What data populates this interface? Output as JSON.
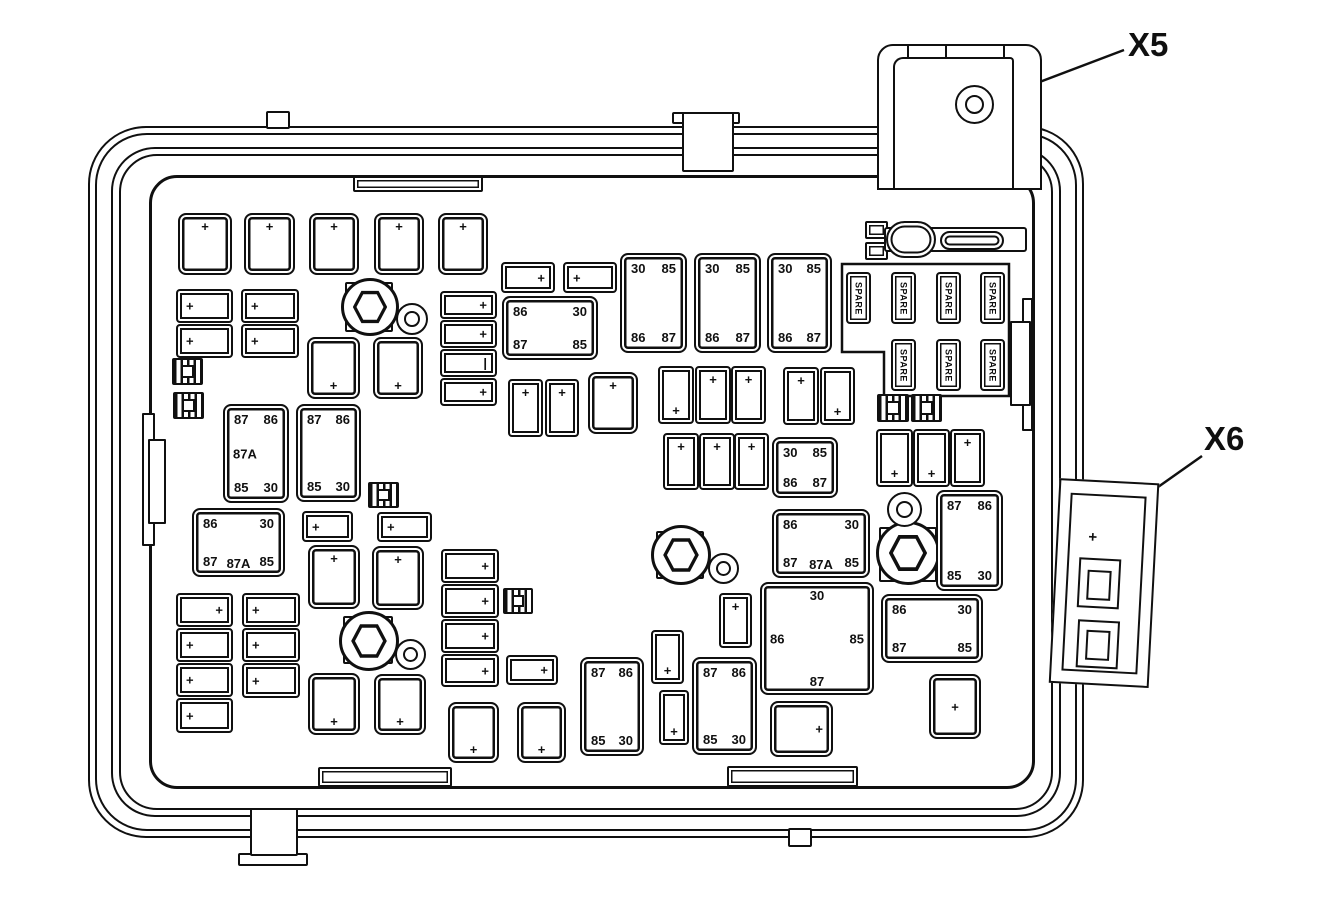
{
  "diagram": {
    "description": "Underhood fuse block line diagram with relay and fuse cavities",
    "connector_labels": {
      "x5": "X5",
      "x6": "X6"
    }
  },
  "labels": {
    "spare": "SPARE",
    "plus": "+",
    "pipe": "|"
  },
  "parts": [
    {
      "t": "rail",
      "x": 142,
      "y": 413,
      "w": 13,
      "h": 133
    },
    {
      "t": "rail",
      "x": 148,
      "y": 439,
      "w": 18,
      "h": 85
    },
    {
      "t": "rail",
      "x": 1022,
      "y": 298,
      "w": 11,
      "h": 133
    },
    {
      "t": "rail",
      "x": 1010,
      "y": 321,
      "w": 21,
      "h": 85
    },
    {
      "t": "ledge",
      "x": 353,
      "y": 176,
      "w": 130,
      "h": 16
    },
    {
      "t": "ledge",
      "x": 318,
      "y": 767,
      "w": 134,
      "h": 20
    },
    {
      "t": "ledge",
      "x": 727,
      "y": 766,
      "w": 131,
      "h": 21
    },
    {
      "t": "tab",
      "x": 266,
      "y": 111,
      "w": 24,
      "h": 18
    },
    {
      "t": "tab",
      "x": 672,
      "y": 112,
      "w": 68,
      "h": 12
    },
    {
      "t": "tab",
      "x": 682,
      "y": 112,
      "w": 52,
      "h": 60
    },
    {
      "t": "tab",
      "x": 238,
      "y": 853,
      "w": 70,
      "h": 13
    },
    {
      "t": "tab",
      "x": 250,
      "y": 808,
      "w": 48,
      "h": 48
    },
    {
      "t": "tab",
      "x": 788,
      "y": 828,
      "w": 24,
      "h": 19
    },
    {
      "t": "sq",
      "x": 865,
      "y": 221,
      "w": 23,
      "h": 18
    },
    {
      "t": "sq",
      "x": 865,
      "y": 242,
      "w": 23,
      "h": 18
    },
    {
      "t": "bar",
      "x": 884,
      "y": 227,
      "w": 143,
      "h": 25
    },
    {
      "t": "pill",
      "x": 886,
      "y": 221,
      "w": 50,
      "h": 37
    },
    {
      "t": "pill",
      "x": 940,
      "y": 231,
      "w": 64,
      "h": 19
    },
    {
      "t": "pad",
      "x": 345,
      "y": 282,
      "w": 48,
      "h": 50
    },
    {
      "t": "hex",
      "x": 341,
      "y": 278,
      "w": 58,
      "h": 58
    },
    {
      "t": "washer",
      "x": 396,
      "y": 303,
      "w": 32,
      "h": 32
    },
    {
      "t": "pad",
      "x": 343,
      "y": 616,
      "w": 50,
      "h": 48
    },
    {
      "t": "hex",
      "x": 339,
      "y": 611,
      "w": 60,
      "h": 60
    },
    {
      "t": "washer",
      "x": 395,
      "y": 639,
      "w": 31,
      "h": 31
    },
    {
      "t": "pad",
      "x": 656,
      "y": 531,
      "w": 48,
      "h": 48
    },
    {
      "t": "hex",
      "x": 651,
      "y": 525,
      "w": 60,
      "h": 60
    },
    {
      "t": "washer",
      "x": 708,
      "y": 553,
      "w": 31,
      "h": 31
    },
    {
      "t": "pad",
      "x": 879,
      "y": 527,
      "w": 58,
      "h": 55
    },
    {
      "t": "hex",
      "x": 876,
      "y": 521,
      "w": 64,
      "h": 64
    },
    {
      "t": "washer",
      "x": 887,
      "y": 492,
      "w": 35,
      "h": 35
    },
    {
      "t": "clip",
      "x": 172,
      "y": 358,
      "w": 31,
      "h": 27
    },
    {
      "t": "clip",
      "x": 173,
      "y": 392,
      "w": 31,
      "h": 27
    },
    {
      "t": "clip",
      "x": 368,
      "y": 482,
      "w": 31,
      "h": 26
    },
    {
      "t": "clip",
      "x": 503,
      "y": 588,
      "w": 30,
      "h": 26
    },
    {
      "t": "clip",
      "x": 877,
      "y": 394,
      "w": 32,
      "h": 28
    },
    {
      "t": "clip",
      "x": 911,
      "y": 394,
      "w": 31,
      "h": 28
    },
    {
      "t": "relay",
      "x": 178,
      "y": 213,
      "w": 54,
      "h": 62,
      "l": {
        "tc": "+"
      }
    },
    {
      "t": "relay",
      "x": 244,
      "y": 213,
      "w": 51,
      "h": 62,
      "l": {
        "tc": "+"
      }
    },
    {
      "t": "relay",
      "x": 309,
      "y": 213,
      "w": 50,
      "h": 62,
      "l": {
        "tc": "+"
      }
    },
    {
      "t": "relay",
      "x": 374,
      "y": 213,
      "w": 50,
      "h": 62,
      "l": {
        "tc": "+"
      }
    },
    {
      "t": "relay",
      "x": 438,
      "y": 213,
      "w": 50,
      "h": 62,
      "l": {
        "tc": "+"
      }
    },
    {
      "t": "fuse",
      "x": 176,
      "y": 289,
      "w": 57,
      "h": 34,
      "l": {
        "ml": "+"
      }
    },
    {
      "t": "fuse",
      "x": 176,
      "y": 324,
      "w": 57,
      "h": 34,
      "l": {
        "ml": "+"
      }
    },
    {
      "t": "fuse",
      "x": 241,
      "y": 289,
      "w": 58,
      "h": 34,
      "l": {
        "ml": "+"
      }
    },
    {
      "t": "fuse",
      "x": 241,
      "y": 324,
      "w": 58,
      "h": 34,
      "l": {
        "ml": "+"
      }
    },
    {
      "t": "fuse",
      "x": 440,
      "y": 291,
      "w": 57,
      "h": 28,
      "l": {
        "mr": "+"
      }
    },
    {
      "t": "fuse",
      "x": 440,
      "y": 320,
      "w": 57,
      "h": 28,
      "l": {
        "mr": "+"
      }
    },
    {
      "t": "fuse",
      "x": 440,
      "y": 349,
      "w": 57,
      "h": 28,
      "l": {
        "mr": "|"
      }
    },
    {
      "t": "fuse",
      "x": 440,
      "y": 378,
      "w": 57,
      "h": 28,
      "l": {
        "mr": "+"
      }
    },
    {
      "t": "relay",
      "x": 307,
      "y": 337,
      "w": 53,
      "h": 62,
      "l": {
        "bc": "+"
      }
    },
    {
      "t": "relay",
      "x": 373,
      "y": 337,
      "w": 50,
      "h": 62,
      "l": {
        "bc": "+"
      }
    },
    {
      "t": "relay",
      "x": 223,
      "y": 404,
      "w": 66,
      "h": 99,
      "l": {
        "tl": "87",
        "tr": "86",
        "ml": "87A",
        "bl": "85",
        "br": "30"
      }
    },
    {
      "t": "relay",
      "x": 296,
      "y": 404,
      "w": 65,
      "h": 98,
      "l": {
        "tl": "87",
        "tr": "86",
        "bl": "85",
        "br": "30"
      }
    },
    {
      "t": "relay",
      "x": 192,
      "y": 508,
      "w": 93,
      "h": 69,
      "l": {
        "tl": "86",
        "tr": "30",
        "bl": "87",
        "bc": "87A",
        "br": "85"
      }
    },
    {
      "t": "fuse",
      "x": 302,
      "y": 511,
      "w": 51,
      "h": 31,
      "l": {
        "ml": "+"
      }
    },
    {
      "t": "fuse",
      "x": 377,
      "y": 512,
      "w": 55,
      "h": 30,
      "l": {
        "ml": "+"
      }
    },
    {
      "t": "relay",
      "x": 308,
      "y": 545,
      "w": 52,
      "h": 64,
      "l": {
        "tc": "+"
      }
    },
    {
      "t": "relay",
      "x": 372,
      "y": 546,
      "w": 52,
      "h": 64,
      "l": {
        "tc": "+"
      }
    },
    {
      "t": "fuse",
      "x": 176,
      "y": 593,
      "w": 57,
      "h": 34,
      "l": {
        "mr": "+"
      }
    },
    {
      "t": "fuse",
      "x": 176,
      "y": 628,
      "w": 57,
      "h": 34,
      "l": {
        "ml": "+"
      }
    },
    {
      "t": "fuse",
      "x": 176,
      "y": 663,
      "w": 57,
      "h": 34,
      "l": {
        "ml": "+"
      }
    },
    {
      "t": "fuse",
      "x": 176,
      "y": 698,
      "w": 57,
      "h": 35,
      "l": {
        "ml": "+"
      }
    },
    {
      "t": "fuse",
      "x": 242,
      "y": 593,
      "w": 58,
      "h": 34,
      "l": {
        "ml": "+"
      }
    },
    {
      "t": "fuse",
      "x": 242,
      "y": 628,
      "w": 58,
      "h": 34,
      "l": {
        "ml": "+"
      }
    },
    {
      "t": "fuse",
      "x": 242,
      "y": 663,
      "w": 58,
      "h": 35,
      "l": {
        "ml": "+"
      }
    },
    {
      "t": "relay",
      "x": 308,
      "y": 673,
      "w": 52,
      "h": 62,
      "l": {
        "bc": "+"
      }
    },
    {
      "t": "relay",
      "x": 374,
      "y": 674,
      "w": 52,
      "h": 61,
      "l": {
        "bc": "+"
      }
    },
    {
      "t": "fuse",
      "x": 441,
      "y": 549,
      "w": 58,
      "h": 34,
      "l": {
        "mr": "+"
      }
    },
    {
      "t": "fuse",
      "x": 441,
      "y": 584,
      "w": 58,
      "h": 34,
      "l": {
        "mr": "+"
      }
    },
    {
      "t": "fuse",
      "x": 441,
      "y": 619,
      "w": 58,
      "h": 34,
      "l": {
        "mr": "+"
      }
    },
    {
      "t": "fuse",
      "x": 441,
      "y": 654,
      "w": 58,
      "h": 33,
      "l": {
        "mr": "+"
      }
    },
    {
      "t": "fuse",
      "x": 506,
      "y": 655,
      "w": 52,
      "h": 30,
      "l": {
        "mr": "+"
      }
    },
    {
      "t": "relay",
      "x": 448,
      "y": 702,
      "w": 51,
      "h": 61,
      "l": {
        "bc": "+"
      }
    },
    {
      "t": "relay",
      "x": 517,
      "y": 702,
      "w": 49,
      "h": 61,
      "l": {
        "bc": "+"
      }
    },
    {
      "t": "fuse",
      "x": 501,
      "y": 262,
      "w": 54,
      "h": 31,
      "l": {
        "mr": "+"
      }
    },
    {
      "t": "fuse",
      "x": 563,
      "y": 262,
      "w": 54,
      "h": 31,
      "l": {
        "ml": "+"
      }
    },
    {
      "t": "relay",
      "x": 502,
      "y": 296,
      "w": 96,
      "h": 64,
      "l": {
        "tl": "86",
        "tr": "30",
        "bl": "87",
        "br": "85"
      }
    },
    {
      "t": "relay",
      "x": 620,
      "y": 253,
      "w": 67,
      "h": 100,
      "l": {
        "tl": "30",
        "tr": "85",
        "bl": "86",
        "br": "87"
      }
    },
    {
      "t": "relay",
      "x": 694,
      "y": 253,
      "w": 67,
      "h": 100,
      "l": {
        "tl": "30",
        "tr": "85",
        "bl": "86",
        "br": "87"
      }
    },
    {
      "t": "relay",
      "x": 767,
      "y": 253,
      "w": 65,
      "h": 100,
      "l": {
        "tl": "30",
        "tr": "85",
        "bl": "86",
        "br": "87"
      }
    },
    {
      "t": "fuse",
      "x": 508,
      "y": 379,
      "w": 35,
      "h": 58,
      "l": {
        "tc": "+"
      }
    },
    {
      "t": "fuse",
      "x": 545,
      "y": 379,
      "w": 34,
      "h": 58,
      "l": {
        "tc": "+"
      }
    },
    {
      "t": "relay",
      "x": 588,
      "y": 372,
      "w": 50,
      "h": 62,
      "l": {
        "tc": "+"
      }
    },
    {
      "t": "fuse",
      "x": 658,
      "y": 366,
      "w": 36,
      "h": 58,
      "l": {
        "bc": "+"
      }
    },
    {
      "t": "fuse",
      "x": 695,
      "y": 366,
      "w": 36,
      "h": 58,
      "l": {
        "tc": "+"
      }
    },
    {
      "t": "fuse",
      "x": 731,
      "y": 366,
      "w": 35,
      "h": 58,
      "l": {
        "tc": "+"
      }
    },
    {
      "t": "fuse",
      "x": 783,
      "y": 367,
      "w": 36,
      "h": 58,
      "l": {
        "tc": "+"
      }
    },
    {
      "t": "fuse",
      "x": 820,
      "y": 367,
      "w": 35,
      "h": 58,
      "l": {
        "bc": "+"
      }
    },
    {
      "t": "fuse",
      "x": 663,
      "y": 433,
      "w": 36,
      "h": 57,
      "l": {
        "tc": "+"
      }
    },
    {
      "t": "fuse",
      "x": 699,
      "y": 433,
      "w": 36,
      "h": 57,
      "l": {
        "tc": "+"
      }
    },
    {
      "t": "fuse",
      "x": 734,
      "y": 433,
      "w": 35,
      "h": 57,
      "l": {
        "tc": "+"
      }
    },
    {
      "t": "relay",
      "x": 772,
      "y": 437,
      "w": 66,
      "h": 61,
      "l": {
        "tl": "30",
        "tr": "85",
        "bl": "86",
        "br": "87"
      }
    },
    {
      "t": "relay",
      "x": 772,
      "y": 509,
      "w": 98,
      "h": 69,
      "l": {
        "tl": "86",
        "tr": "30",
        "bl": "87",
        "bc": "87A",
        "br": "85"
      }
    },
    {
      "t": "fuse",
      "x": 876,
      "y": 429,
      "w": 37,
      "h": 58,
      "l": {
        "bc": "+"
      }
    },
    {
      "t": "fuse",
      "x": 913,
      "y": 429,
      "w": 37,
      "h": 58,
      "l": {
        "bc": "+"
      }
    },
    {
      "t": "fuse",
      "x": 950,
      "y": 429,
      "w": 35,
      "h": 58,
      "l": {
        "tc": "+"
      }
    },
    {
      "t": "relay",
      "x": 936,
      "y": 490,
      "w": 67,
      "h": 101,
      "l": {
        "tl": "87",
        "tr": "86",
        "bl": "85",
        "br": "30"
      }
    },
    {
      "t": "relay",
      "x": 760,
      "y": 582,
      "w": 114,
      "h": 113,
      "l": {
        "tc": "30",
        "ml": "86",
        "mr": "85",
        "bc": "87"
      }
    },
    {
      "t": "relay",
      "x": 881,
      "y": 594,
      "w": 102,
      "h": 69,
      "l": {
        "tl": "86",
        "tr": "30",
        "bl": "87",
        "br": "85"
      }
    },
    {
      "t": "relay",
      "x": 929,
      "y": 674,
      "w": 52,
      "h": 65,
      "l": {
        "mc": "+"
      }
    },
    {
      "t": "relay",
      "x": 770,
      "y": 701,
      "w": 63,
      "h": 56,
      "l": {
        "mr": "+"
      }
    },
    {
      "t": "relay",
      "x": 580,
      "y": 657,
      "w": 64,
      "h": 99,
      "l": {
        "tl": "87",
        "tr": "86",
        "bl": "85",
        "br": "30"
      }
    },
    {
      "t": "relay",
      "x": 692,
      "y": 657,
      "w": 65,
      "h": 98,
      "l": {
        "tl": "87",
        "tr": "86",
        "bl": "85",
        "br": "30"
      }
    },
    {
      "t": "fuse",
      "x": 651,
      "y": 630,
      "w": 33,
      "h": 54,
      "l": {
        "bc": "+"
      }
    },
    {
      "t": "fuse",
      "x": 659,
      "y": 690,
      "w": 30,
      "h": 55,
      "l": {
        "bc": "+"
      }
    },
    {
      "t": "fuse",
      "x": 719,
      "y": 593,
      "w": 33,
      "h": 55,
      "l": {
        "tc": "+"
      }
    },
    {
      "t": "spare",
      "x": 846,
      "y": 272,
      "w": 25,
      "h": 52
    },
    {
      "t": "spare",
      "x": 891,
      "y": 272,
      "w": 25,
      "h": 52
    },
    {
      "t": "spare",
      "x": 936,
      "y": 272,
      "w": 25,
      "h": 52
    },
    {
      "t": "spare",
      "x": 980,
      "y": 272,
      "w": 25,
      "h": 52
    },
    {
      "t": "spare",
      "x": 891,
      "y": 339,
      "w": 25,
      "h": 52
    },
    {
      "t": "spare",
      "x": 936,
      "y": 339,
      "w": 25,
      "h": 52
    },
    {
      "t": "spare",
      "x": 980,
      "y": 339,
      "w": 25,
      "h": 52
    }
  ]
}
